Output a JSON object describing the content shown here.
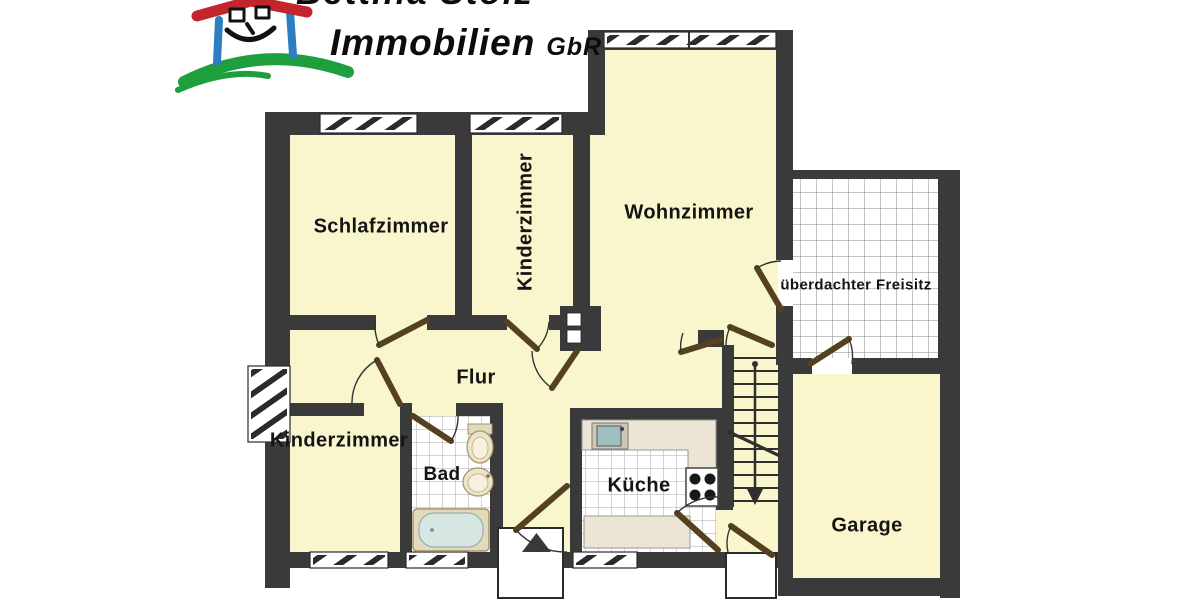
{
  "logo": {
    "company_line_cut": "Bettina Stolz",
    "brand": "Immobilien",
    "suffix": "GbR"
  },
  "rooms": [
    {
      "id": "schlafzimmer",
      "label": "Schlafzimmer"
    },
    {
      "id": "kinderzimmer-top",
      "label": "Kinderzimmer"
    },
    {
      "id": "wohnzimmer",
      "label": "Wohnzimmer"
    },
    {
      "id": "freisitz",
      "label": "überdachter Freisitz"
    },
    {
      "id": "flur",
      "label": "Flur"
    },
    {
      "id": "kinderzimmer-bottom",
      "label": "Kinderzimmer"
    },
    {
      "id": "bad",
      "label": "Bad"
    },
    {
      "id": "kueche",
      "label": "Küche"
    },
    {
      "id": "garage",
      "label": "Garage"
    }
  ],
  "icons": {
    "entrance_arrow": "triangle-up-entrance-marker",
    "stairs_arrow": "stairs-direction-down-arrow"
  },
  "colors": {
    "wall": "#3a3a3a",
    "room_fill": "#f9f5cd",
    "door_panel": "#55401f",
    "logo_red": "#c4242b",
    "logo_blue": "#2b7fc0",
    "logo_green": "#1f9e3e"
  }
}
